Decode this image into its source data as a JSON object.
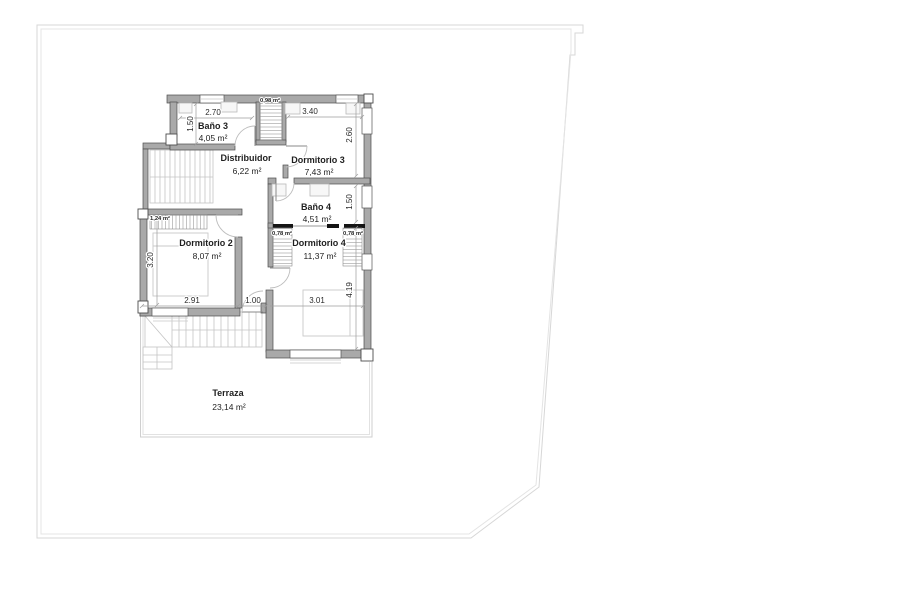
{
  "plan": {
    "rooms": [
      {
        "id": "bano3",
        "name": "Baño 3",
        "area": "4,05 m²"
      },
      {
        "id": "distribuidor",
        "name": "Distribuidor",
        "area": "6,22 m²"
      },
      {
        "id": "dormitorio3",
        "name": "Dormitorio 3",
        "area": "7,43 m²"
      },
      {
        "id": "bano4",
        "name": "Baño 4",
        "area": "4,51 m²"
      },
      {
        "id": "dormitorio2",
        "name": "Dormitorio 2",
        "area": "8,07 m²"
      },
      {
        "id": "dormitorio4",
        "name": "Dormitorio 4",
        "area": "11,37 m²"
      },
      {
        "id": "terraza",
        "name": "Terraza",
        "area": "23,14 m²"
      }
    ],
    "closets": [
      {
        "id": "closet-top",
        "area": "0,98 m²"
      },
      {
        "id": "closet-dorm2",
        "area": "1,24 m²"
      },
      {
        "id": "closet-dorm4-left",
        "area": "0,78 m²"
      },
      {
        "id": "closet-dorm4-right",
        "area": "0,78 m²"
      }
    ],
    "dimensions": [
      {
        "edge": "bano3-width",
        "label": "2.70"
      },
      {
        "edge": "bano3-height",
        "label": "1.50"
      },
      {
        "edge": "dormitorio3-width",
        "label": "3.40"
      },
      {
        "edge": "dormitorio3-height",
        "label": "2.60"
      },
      {
        "edge": "bano4-height",
        "label": "1.50"
      },
      {
        "edge": "dormitorio2-height",
        "label": "3.20"
      },
      {
        "edge": "dormitorio2-width",
        "label": "2.91"
      },
      {
        "edge": "hall-width",
        "label": "1.00"
      },
      {
        "edge": "dormitorio4-width",
        "label": "3.01"
      },
      {
        "edge": "dormitorio4-height",
        "label": "4.19"
      }
    ],
    "colors": {
      "wall": "#a9a9a9",
      "wall_outline": "#4d4d4d",
      "dark_bar": "#141414",
      "plot_boundary": "#d7d7d7",
      "terrace_line": "#cfcfcf",
      "stair": "#c4c4c4",
      "text": "#1f1f1f",
      "background": "#ffffff"
    }
  }
}
